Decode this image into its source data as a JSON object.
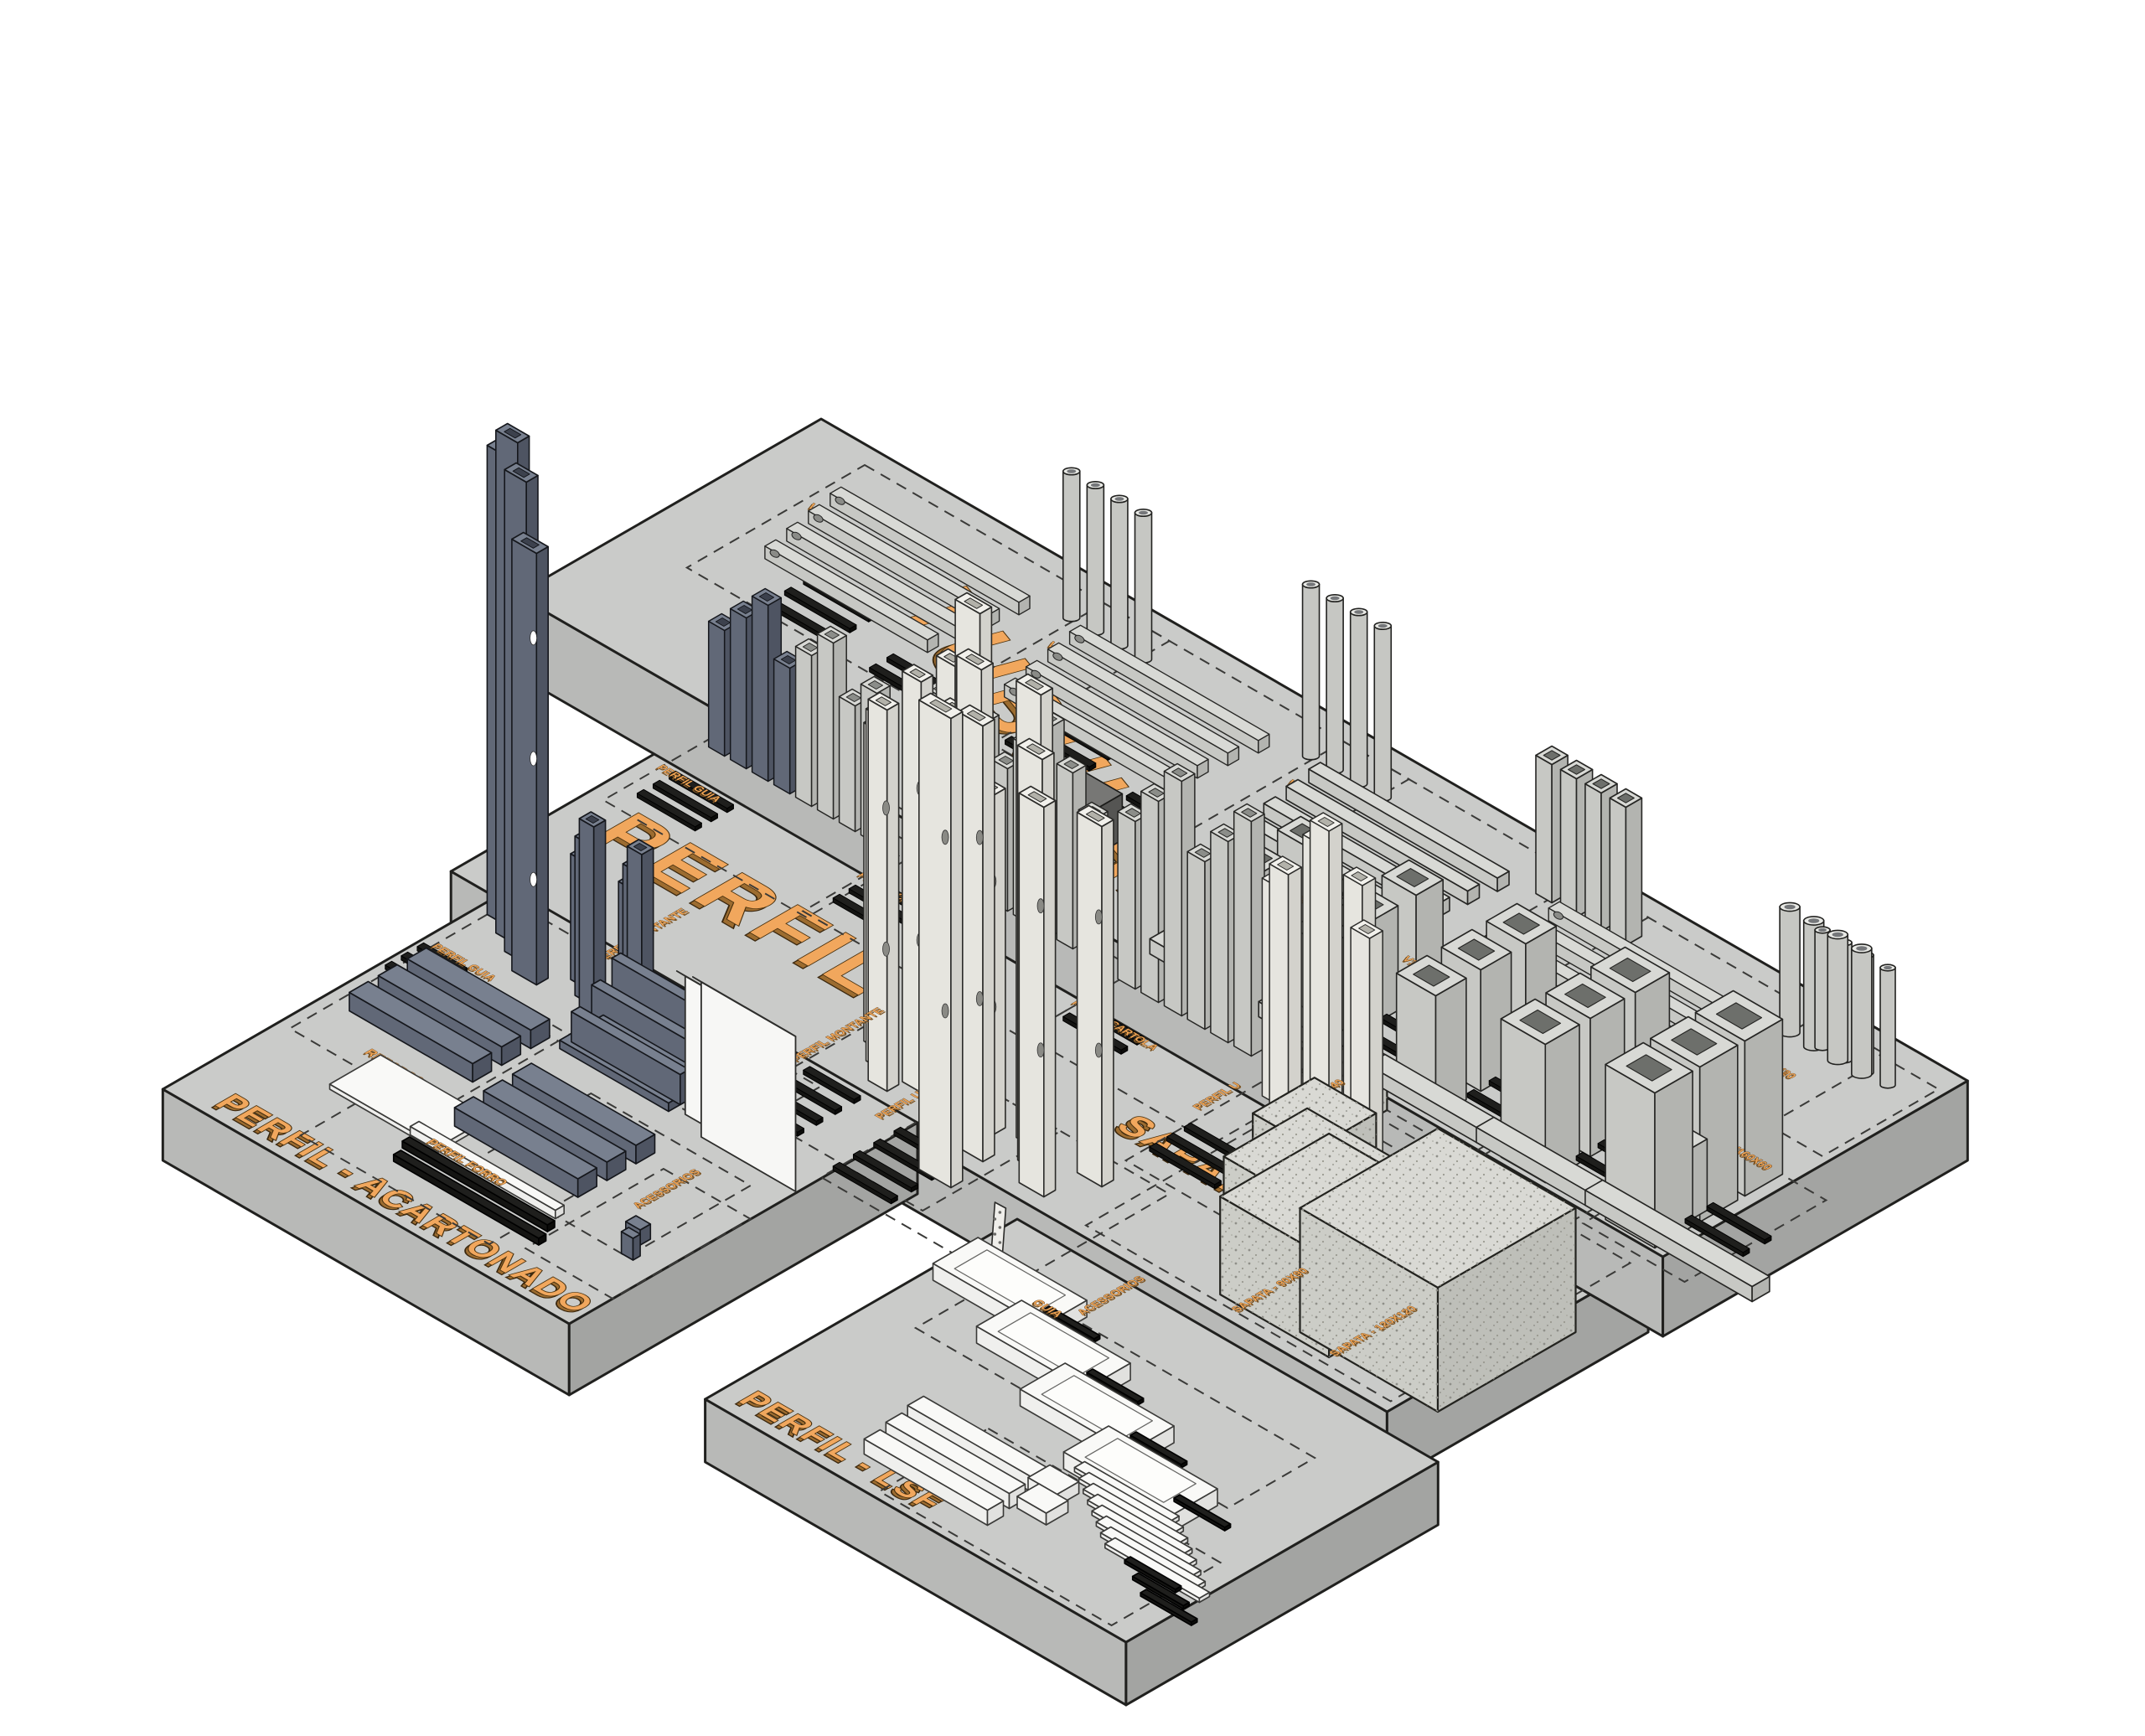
{
  "illustration": {
    "background": "#ffffff",
    "accent_orange": "#f1a75d",
    "platform_gray": "#cacbc9",
    "big_labels": {
      "tubular": "TUBULAR",
      "perfil": "PERFIL",
      "acartonado": "PERFIL - ACARTONADO",
      "lsf": "PERFIL - LSF",
      "sapata": "SAPATA"
    },
    "small_labels": {
      "reforco": "REFORÇO",
      "perfil_forro": "PERFIL FORRO",
      "acessorios": "ACESSORIOS",
      "guia": "GUIA",
      "perfil_guia": "PERFIL GUIA",
      "perfil_montante": "PERFIL MONTANTE",
      "perfil_canaleta": "PERFIL CANALETA",
      "perfil_cartola": "PERFIL CARTOLA",
      "perfil_u": "PERFIL U",
      "perfil_ue": "PERFIL UE",
      "sapata_40": "SAPATA - 40X40",
      "sapata_60": "SAPATA - 60X60",
      "sapata_80": "SAPATA - 80X80",
      "sapata_90": "SAPATA - 90X90",
      "sapata_120": "SAPATA - 120X120",
      "v20": "V20X20",
      "v30": "V30X30",
      "v40": "V40X40",
      "v50": "V50X50",
      "v60": "V60X60",
      "v80": "V80X40",
      "v100": "V100X50",
      "v120": "V120X60",
      "v140": "V140X60",
      "v160": "V160X60"
    }
  }
}
